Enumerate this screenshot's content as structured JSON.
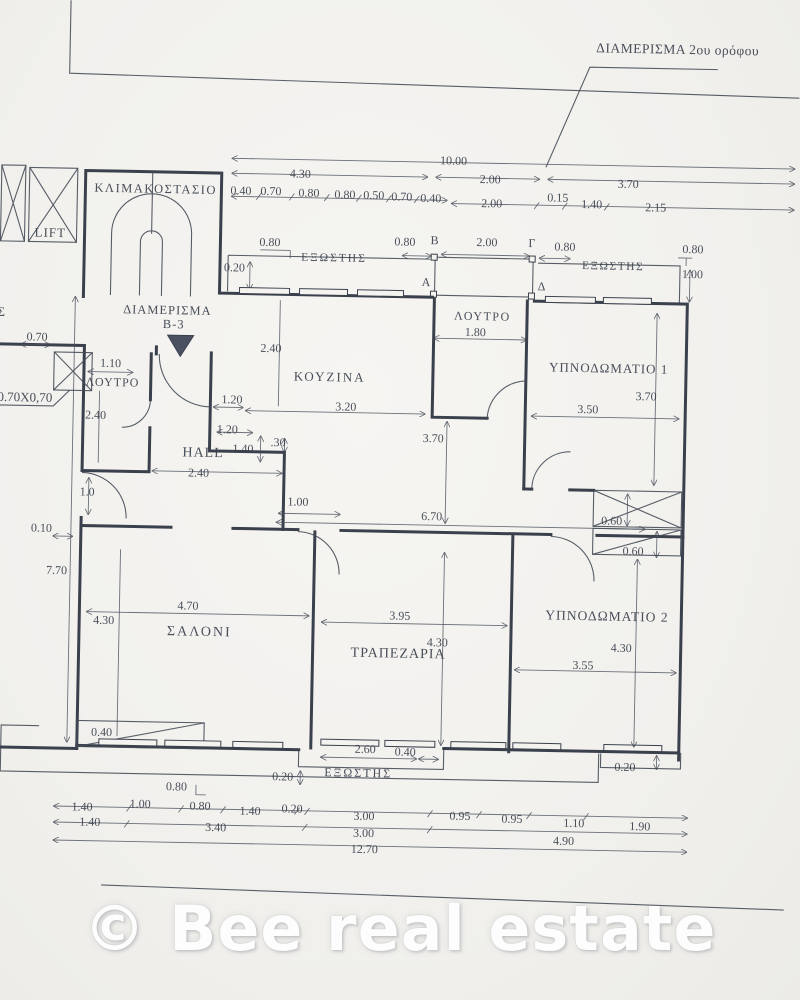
{
  "title": "ΔΙΑΜΕΡΙΣΜΑ  2ου ορόφου",
  "watermark": "© Bee real estate",
  "rooms": {
    "stairwell": "ΚΛΙΜΑΚΟΣΤΑΣΙΟ",
    "lift": "LIFT",
    "apartment_line1": "ΔΙΑΜΕΡΙΣΜΑ",
    "apartment_line2": "Β-3",
    "bath_top": "ΛΟΥΤΡΟ",
    "bath_left": "ΛΟΥΤΡΟ",
    "kitchen": "ΚΟΥΖΙΝΑ",
    "hall": "HALL",
    "bedroom1": "ΥΠΝΟΔΩΜΑΤΙΟ 1",
    "bedroom2": "ΥΠΝΟΔΩΜΑΤΙΟ 2",
    "living": "ΣΑΛΟΝΙ",
    "dining": "ΤΡΑΠΕΖΑΡΙΑ",
    "balcony_top_left": "ΕΞΩΣΤΗΣ",
    "balcony_top_right": "ΕΞΩΣΤΗΣ",
    "balcony_bottom": "ΕΞΩΣΤΗΣ",
    "edge_partial": "ΟΣ"
  },
  "markers": {
    "a": "A",
    "b": "B",
    "gamma": "Γ",
    "delta": "Δ",
    "column_size": "0.70X0,70"
  },
  "dims": {
    "top_total": "10.00",
    "top_row2": [
      "4.30",
      "2.00",
      "3.70"
    ],
    "top_row3": [
      "0.40",
      "0.70",
      "0.80",
      "0.80",
      "0.50",
      "0.70",
      "0.40",
      "2.00",
      "0.15",
      "1.40",
      "2.15"
    ],
    "balcony_left": [
      "0.20",
      "0.80",
      "0.80"
    ],
    "balcony_mid": "2.00",
    "balcony_right": [
      "0.80",
      "0.80",
      "1.00"
    ],
    "bath_top_width": "1.80",
    "bedroom1": [
      "3.70",
      "3.50"
    ],
    "kitchen": [
      "2.40",
      "3.20",
      "1.20",
      "1.20",
      "1.40",
      ".30"
    ],
    "bath_left": [
      "0.70",
      "1.10",
      "2.40"
    ],
    "hall": [
      "2.40",
      "1.0",
      "1.00"
    ],
    "corridor": [
      "3.70",
      "6.70",
      "0.60",
      "0.60",
      "0.10",
      "7.70"
    ],
    "living": [
      "4.70",
      "4.30"
    ],
    "dining": [
      "3.95",
      "4.30"
    ],
    "bedroom2": [
      "4.30",
      "3.55"
    ],
    "bottom_mid": [
      "2.60",
      "0.40",
      "0.20",
      "0.80",
      "0.40"
    ],
    "bottom_right": "0.20",
    "chain1": [
      "1.40",
      "1.00",
      "0.80",
      "1.40",
      "0.20",
      "3.00",
      "0.95",
      "0.95",
      "1.10",
      "1.90"
    ],
    "chain2": [
      "1.40",
      "3.40",
      "3.00",
      "4.90"
    ],
    "chain3": "12.70"
  }
}
